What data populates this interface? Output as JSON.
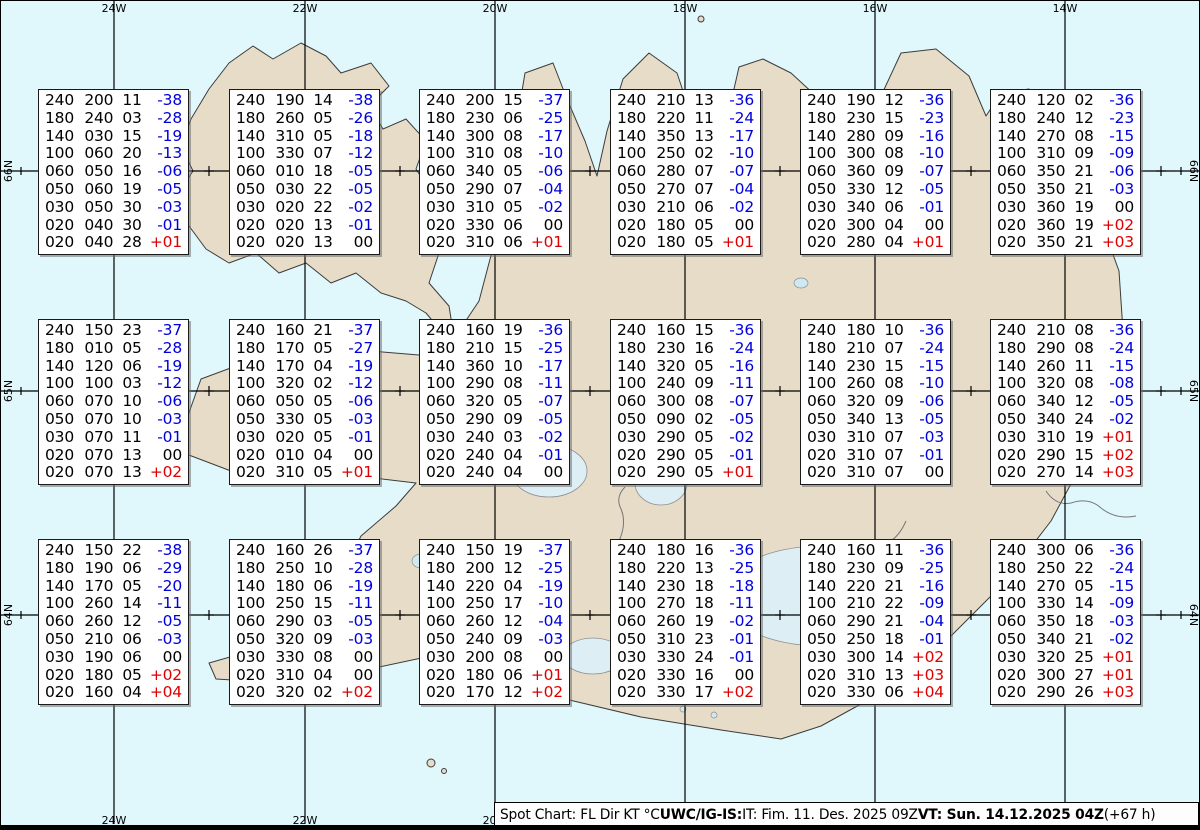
{
  "colors": {
    "sea": "#e0f7fc",
    "land": "#e7dcc8",
    "coast": "#3c3c3c",
    "glacier": "#ddeef5",
    "lake": "#cfe9f2",
    "temp_negative": "#0000dd",
    "temp_positive": "#dd0000",
    "ink": "#000000"
  },
  "graticule": {
    "meridians": [
      {
        "label": "24W",
        "x": 113
      },
      {
        "label": "22W",
        "x": 304
      },
      {
        "label": "20W",
        "x": 494
      },
      {
        "label": "18W",
        "x": 684
      },
      {
        "label": "16W",
        "x": 874
      },
      {
        "label": "14W",
        "x": 1064
      }
    ],
    "parallels": [
      {
        "label": "66N",
        "y": 170
      },
      {
        "label": "65N",
        "y": 390
      },
      {
        "label": "64N",
        "y": 614
      }
    ],
    "minor_x": [
      208,
      399,
      589,
      779,
      970,
      1160
    ]
  },
  "chart_data": {
    "type": "table",
    "title": "Spot Chart: FL Dir KT °C",
    "columns": [
      "FL",
      "Dir",
      "KT",
      "TempC"
    ],
    "stations": [
      {
        "row": 0,
        "col": 0,
        "levels": [
          [
            "240",
            "200",
            "11",
            "-38"
          ],
          [
            "180",
            "240",
            "03",
            "-28"
          ],
          [
            "140",
            "030",
            "15",
            "-19"
          ],
          [
            "100",
            "060",
            "20",
            "-13"
          ],
          [
            "060",
            "050",
            "16",
            "-06"
          ],
          [
            "050",
            "060",
            "19",
            "-05"
          ],
          [
            "030",
            "050",
            "30",
            "-03"
          ],
          [
            "020",
            "040",
            "30",
            "-01"
          ],
          [
            "020",
            "040",
            "28",
            "+01"
          ]
        ]
      },
      {
        "row": 0,
        "col": 1,
        "levels": [
          [
            "240",
            "190",
            "14",
            "-38"
          ],
          [
            "180",
            "260",
            "05",
            "-26"
          ],
          [
            "140",
            "310",
            "05",
            "-18"
          ],
          [
            "100",
            "330",
            "07",
            "-12"
          ],
          [
            "060",
            "010",
            "18",
            "-05"
          ],
          [
            "050",
            "030",
            "22",
            "-05"
          ],
          [
            "030",
            "020",
            "22",
            "-02"
          ],
          [
            "020",
            "020",
            "13",
            "-01"
          ],
          [
            "020",
            "020",
            "13",
            "00"
          ]
        ]
      },
      {
        "row": 0,
        "col": 2,
        "levels": [
          [
            "240",
            "200",
            "15",
            "-37"
          ],
          [
            "180",
            "230",
            "06",
            "-25"
          ],
          [
            "140",
            "300",
            "08",
            "-17"
          ],
          [
            "100",
            "310",
            "08",
            "-10"
          ],
          [
            "060",
            "340",
            "05",
            "-06"
          ],
          [
            "050",
            "290",
            "07",
            "-04"
          ],
          [
            "030",
            "310",
            "05",
            "-02"
          ],
          [
            "020",
            "330",
            "06",
            "00"
          ],
          [
            "020",
            "310",
            "06",
            "+01"
          ]
        ]
      },
      {
        "row": 0,
        "col": 3,
        "levels": [
          [
            "240",
            "210",
            "13",
            "-36"
          ],
          [
            "180",
            "220",
            "11",
            "-24"
          ],
          [
            "140",
            "350",
            "13",
            "-17"
          ],
          [
            "100",
            "250",
            "02",
            "-10"
          ],
          [
            "060",
            "280",
            "07",
            "-07"
          ],
          [
            "050",
            "270",
            "07",
            "-04"
          ],
          [
            "030",
            "210",
            "06",
            "-02"
          ],
          [
            "020",
            "180",
            "05",
            "00"
          ],
          [
            "020",
            "180",
            "05",
            "+01"
          ]
        ]
      },
      {
        "row": 0,
        "col": 4,
        "levels": [
          [
            "240",
            "190",
            "12",
            "-36"
          ],
          [
            "180",
            "230",
            "15",
            "-23"
          ],
          [
            "140",
            "280",
            "09",
            "-16"
          ],
          [
            "100",
            "300",
            "08",
            "-10"
          ],
          [
            "060",
            "360",
            "09",
            "-07"
          ],
          [
            "050",
            "330",
            "12",
            "-05"
          ],
          [
            "030",
            "340",
            "06",
            "-01"
          ],
          [
            "020",
            "300",
            "04",
            "00"
          ],
          [
            "020",
            "280",
            "04",
            "+01"
          ]
        ]
      },
      {
        "row": 0,
        "col": 5,
        "levels": [
          [
            "240",
            "120",
            "02",
            "-36"
          ],
          [
            "180",
            "240",
            "12",
            "-23"
          ],
          [
            "140",
            "270",
            "08",
            "-15"
          ],
          [
            "100",
            "310",
            "09",
            "-09"
          ],
          [
            "060",
            "350",
            "21",
            "-06"
          ],
          [
            "050",
            "350",
            "21",
            "-03"
          ],
          [
            "030",
            "360",
            "19",
            "00"
          ],
          [
            "020",
            "360",
            "19",
            "+02"
          ],
          [
            "020",
            "350",
            "21",
            "+03"
          ]
        ]
      },
      {
        "row": 1,
        "col": 0,
        "levels": [
          [
            "240",
            "150",
            "23",
            "-37"
          ],
          [
            "180",
            "010",
            "05",
            "-28"
          ],
          [
            "140",
            "120",
            "06",
            "-19"
          ],
          [
            "100",
            "100",
            "03",
            "-12"
          ],
          [
            "060",
            "070",
            "10",
            "-06"
          ],
          [
            "050",
            "070",
            "10",
            "-03"
          ],
          [
            "030",
            "070",
            "11",
            "-01"
          ],
          [
            "020",
            "070",
            "13",
            "00"
          ],
          [
            "020",
            "070",
            "13",
            "+02"
          ]
        ]
      },
      {
        "row": 1,
        "col": 1,
        "levels": [
          [
            "240",
            "160",
            "21",
            "-37"
          ],
          [
            "180",
            "170",
            "05",
            "-27"
          ],
          [
            "140",
            "170",
            "04",
            "-19"
          ],
          [
            "100",
            "320",
            "02",
            "-12"
          ],
          [
            "060",
            "050",
            "05",
            "-06"
          ],
          [
            "050",
            "330",
            "05",
            "-03"
          ],
          [
            "030",
            "020",
            "05",
            "-01"
          ],
          [
            "020",
            "010",
            "04",
            "00"
          ],
          [
            "020",
            "310",
            "05",
            "+01"
          ]
        ]
      },
      {
        "row": 1,
        "col": 2,
        "levels": [
          [
            "240",
            "160",
            "19",
            "-36"
          ],
          [
            "180",
            "210",
            "15",
            "-25"
          ],
          [
            "140",
            "360",
            "10",
            "-17"
          ],
          [
            "100",
            "290",
            "08",
            "-11"
          ],
          [
            "060",
            "320",
            "05",
            "-07"
          ],
          [
            "050",
            "290",
            "09",
            "-05"
          ],
          [
            "030",
            "240",
            "03",
            "-02"
          ],
          [
            "020",
            "240",
            "04",
            "-01"
          ],
          [
            "020",
            "240",
            "04",
            "00"
          ]
        ]
      },
      {
        "row": 1,
        "col": 3,
        "levels": [
          [
            "240",
            "160",
            "15",
            "-36"
          ],
          [
            "180",
            "230",
            "16",
            "-24"
          ],
          [
            "140",
            "320",
            "05",
            "-16"
          ],
          [
            "100",
            "240",
            "09",
            "-11"
          ],
          [
            "060",
            "300",
            "08",
            "-07"
          ],
          [
            "050",
            "090",
            "02",
            "-05"
          ],
          [
            "030",
            "290",
            "05",
            "-02"
          ],
          [
            "020",
            "290",
            "05",
            "-01"
          ],
          [
            "020",
            "290",
            "05",
            "+01"
          ]
        ]
      },
      {
        "row": 1,
        "col": 4,
        "levels": [
          [
            "240",
            "180",
            "10",
            "-36"
          ],
          [
            "180",
            "210",
            "07",
            "-24"
          ],
          [
            "140",
            "230",
            "15",
            "-15"
          ],
          [
            "100",
            "260",
            "08",
            "-10"
          ],
          [
            "060",
            "320",
            "09",
            "-06"
          ],
          [
            "050",
            "340",
            "13",
            "-05"
          ],
          [
            "030",
            "310",
            "07",
            "-03"
          ],
          [
            "020",
            "310",
            "07",
            "-01"
          ],
          [
            "020",
            "310",
            "07",
            "00"
          ]
        ]
      },
      {
        "row": 1,
        "col": 5,
        "levels": [
          [
            "240",
            "210",
            "08",
            "-36"
          ],
          [
            "180",
            "290",
            "08",
            "-24"
          ],
          [
            "140",
            "260",
            "11",
            "-15"
          ],
          [
            "100",
            "320",
            "08",
            "-08"
          ],
          [
            "060",
            "340",
            "12",
            "-05"
          ],
          [
            "050",
            "340",
            "24",
            "-02"
          ],
          [
            "030",
            "310",
            "19",
            "+01"
          ],
          [
            "020",
            "290",
            "15",
            "+02"
          ],
          [
            "020",
            "270",
            "14",
            "+03"
          ]
        ]
      },
      {
        "row": 2,
        "col": 0,
        "levels": [
          [
            "240",
            "150",
            "22",
            "-38"
          ],
          [
            "180",
            "190",
            "06",
            "-29"
          ],
          [
            "140",
            "170",
            "05",
            "-20"
          ],
          [
            "100",
            "260",
            "14",
            "-11"
          ],
          [
            "060",
            "260",
            "12",
            "-05"
          ],
          [
            "050",
            "210",
            "06",
            "-03"
          ],
          [
            "030",
            "190",
            "06",
            "00"
          ],
          [
            "020",
            "180",
            "05",
            "+02"
          ],
          [
            "020",
            "160",
            "04",
            "+04"
          ]
        ]
      },
      {
        "row": 2,
        "col": 1,
        "levels": [
          [
            "240",
            "160",
            "26",
            "-37"
          ],
          [
            "180",
            "250",
            "10",
            "-28"
          ],
          [
            "140",
            "180",
            "06",
            "-19"
          ],
          [
            "100",
            "250",
            "15",
            "-11"
          ],
          [
            "060",
            "290",
            "03",
            "-05"
          ],
          [
            "050",
            "320",
            "09",
            "-03"
          ],
          [
            "030",
            "330",
            "08",
            "00"
          ],
          [
            "020",
            "310",
            "04",
            "00"
          ],
          [
            "020",
            "320",
            "02",
            "+02"
          ]
        ]
      },
      {
        "row": 2,
        "col": 2,
        "levels": [
          [
            "240",
            "150",
            "19",
            "-37"
          ],
          [
            "180",
            "200",
            "12",
            "-25"
          ],
          [
            "140",
            "220",
            "04",
            "-19"
          ],
          [
            "100",
            "250",
            "17",
            "-10"
          ],
          [
            "060",
            "260",
            "12",
            "-04"
          ],
          [
            "050",
            "240",
            "09",
            "-03"
          ],
          [
            "030",
            "200",
            "08",
            "00"
          ],
          [
            "020",
            "180",
            "06",
            "+01"
          ],
          [
            "020",
            "170",
            "12",
            "+02"
          ]
        ]
      },
      {
        "row": 2,
        "col": 3,
        "levels": [
          [
            "240",
            "180",
            "16",
            "-36"
          ],
          [
            "180",
            "220",
            "13",
            "-25"
          ],
          [
            "140",
            "230",
            "18",
            "-18"
          ],
          [
            "100",
            "270",
            "18",
            "-11"
          ],
          [
            "060",
            "260",
            "19",
            "-02"
          ],
          [
            "050",
            "310",
            "23",
            "-01"
          ],
          [
            "030",
            "330",
            "24",
            "-01"
          ],
          [
            "020",
            "330",
            "16",
            "00"
          ],
          [
            "020",
            "330",
            "17",
            "+02"
          ]
        ]
      },
      {
        "row": 2,
        "col": 4,
        "levels": [
          [
            "240",
            "160",
            "11",
            "-36"
          ],
          [
            "180",
            "230",
            "09",
            "-25"
          ],
          [
            "140",
            "220",
            "21",
            "-16"
          ],
          [
            "100",
            "210",
            "22",
            "-09"
          ],
          [
            "060",
            "290",
            "21",
            "-04"
          ],
          [
            "050",
            "250",
            "18",
            "-01"
          ],
          [
            "030",
            "300",
            "14",
            "+02"
          ],
          [
            "020",
            "310",
            "13",
            "+03"
          ],
          [
            "020",
            "330",
            "06",
            "+04"
          ]
        ]
      },
      {
        "row": 2,
        "col": 5,
        "levels": [
          [
            "240",
            "300",
            "06",
            "-36"
          ],
          [
            "180",
            "250",
            "22",
            "-24"
          ],
          [
            "140",
            "270",
            "05",
            "-15"
          ],
          [
            "100",
            "330",
            "14",
            "-09"
          ],
          [
            "060",
            "350",
            "18",
            "-03"
          ],
          [
            "050",
            "340",
            "21",
            "-02"
          ],
          [
            "030",
            "320",
            "25",
            "+01"
          ],
          [
            "020",
            "300",
            "27",
            "+01"
          ],
          [
            "020",
            "290",
            "26",
            "+03"
          ]
        ]
      }
    ]
  },
  "status_bar": {
    "segments": [
      {
        "text": "Spot Chart: FL Dir KT °C ",
        "bold": false
      },
      {
        "text": "UWC/IG-IS:",
        "bold": true
      },
      {
        "text": " IT: Fim. 11. Des. 2025 09Z ",
        "bold": false
      },
      {
        "text": "VT: Sun. 14.12.2025 04Z",
        "bold": true
      },
      {
        "text": " (+67 h)",
        "bold": false
      }
    ]
  }
}
